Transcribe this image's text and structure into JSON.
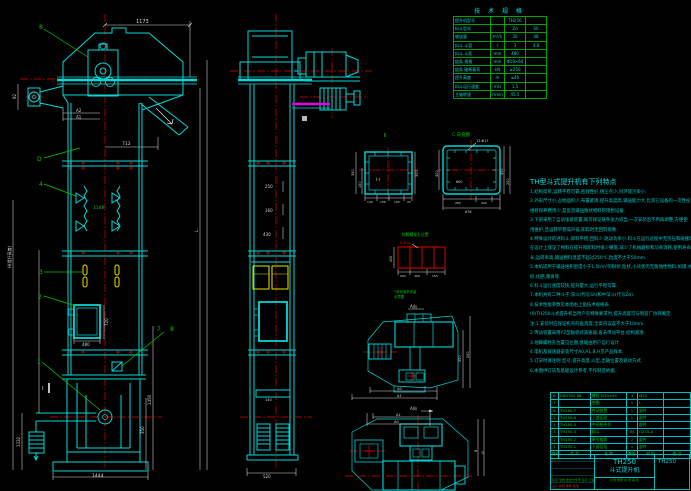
{
  "colors": {
    "cyan": "#00d9d9",
    "green": "#00cc00",
    "red": "#e60000",
    "yellow": "#e6e600",
    "magenta": "#e600e6",
    "white": "#d9d9d9",
    "bg": "#000000"
  },
  "front": {
    "balloon_8": "8",
    "balloon_d": "D",
    "balloon_4": "4",
    "balloon_3": "3",
    "balloon_2": "2",
    "balloon_1": "1",
    "balloon_7": "7",
    "balloon_8b": "8",
    "section_mark": "Ⅰ",
    "dim_top": "1173",
    "dim_head_h": "92",
    "dim_chute": "712",
    "dim_a2": "A2",
    "dim_a1": "A1",
    "dim_pitch": "1189",
    "dim_door_w": "480",
    "dim_door_h": "720",
    "dim_cw": "1332",
    "dim_boot_h": "1450",
    "dim_boot_h2": "350",
    "dim_base": "1444",
    "dim_height_label": "H(提升高度)",
    "dim_l": "L"
  },
  "side": {
    "dim_1": "250",
    "dim_2": "160",
    "dim_3": "430",
    "dim_4": "140",
    "dim_base": "520"
  },
  "section_i": {
    "label": "Ⅱ",
    "inner": "Ⅰ-Ⅰ",
    "dim_left_1": "350",
    "dim_left_2": "150",
    "dim_right": "300",
    "dims_bottom": [
      "140",
      "156",
      "195",
      "22"
    ]
  },
  "section_c": {
    "label": "C 向视图",
    "note": "12-Φ17",
    "dim_in": "600",
    "dim_b1": "260",
    "dim_b2": "200",
    "dim_total": "678",
    "dim_r1": "450",
    "dim_r2": "200",
    "dim_l": "400"
  },
  "anchor": {
    "label": "地脚螺栓孔位置",
    "note": "8-Φ18",
    "dim_left": "425",
    "dims_bottom": [
      "200",
      "300",
      "155"
    ]
  },
  "drive_side": {
    "label_1": "Y系列电机安装",
    "label_2": "示意图",
    "view_mark": "A向",
    "dim_r1": "350",
    "dim_r2": "550"
  },
  "drive_plan": {
    "view_mark": "A向",
    "dim_t1": "A0",
    "dim_t2": "A1",
    "dim_p1": "A1",
    "dim_p2": "A0",
    "dim_r1": "B",
    "dim_r2": "H"
  },
  "spec_table": {
    "title": "技 术 规 格",
    "rows": [
      {
        "label": "提升机型号",
        "unit": "",
        "v1": "TH250",
        "v2": ""
      },
      {
        "label": "料斗型式",
        "unit": "",
        "v1": "Zd",
        "v2": "Sh"
      },
      {
        "label": "输送量",
        "unit": "m³/h",
        "v1": "30",
        "v2": "48"
      },
      {
        "label": "料斗 斗容",
        "unit": "l",
        "v1": "3",
        "v2": "4.8"
      },
      {
        "label": "料斗 斗距",
        "unit": "mm",
        "v1": "480",
        "v2": ""
      },
      {
        "label": "链条 规格",
        "unit": "mm",
        "v1": "Φ18×64",
        "v2": ""
      },
      {
        "label": "链条 破断载荷",
        "unit": "kN",
        "v1": "≥250",
        "v2": ""
      },
      {
        "label": "提升高度",
        "unit": "m",
        "v1": "≤40",
        "v2": ""
      },
      {
        "label": "料斗运行速度",
        "unit": "m/s",
        "v1": "1.5",
        "v2": ""
      },
      {
        "label": "主轴转速",
        "unit": "r/min",
        "v1": "45.5",
        "v2": ""
      }
    ]
  },
  "features": {
    "heading": "TH型斗式提升机有下列特点",
    "lines": [
      "1.结构简单,运转平稳可靠,密封性好,扬尘点少,对环境污染小.",
      "2.外形尺寸小,占地面积少,布置紧凑,提升高度高,输送能力大,比其它设备的一次性投资省,",
      "  维修保养费用少,是竖直输送散状物料的理想设备.",
      "3.下部采用了自动张紧装置,既可保证链条张力适当,一次安装后不用再调整,方便使",
      "  用维护,且运转平稳噪声低,卸料时无回料现象.",
      "4.特殊设计的进料斗,卸料平稳,回料少,驱动功率小,料斗在运行过程中无挤压和碰撞现象,本机",
      "  在设计上保证了物料在提升和卸料时很少撒落,减少了机械磨损和功率消耗,使用寿命",
      "  长,运转率高,输送物料温度不超过250℃,粒度不大于50mm.",
      "5.本机适用于输送堆积密度小于1.5t/m³的粉状,粒状,小块状的无腐蚀性物料,如煤,水泥,",
      "  砂,化肥,粮食等.",
      "6.料斗运行速度较快,提升量大,运行平稳可靠.",
      "7.本机共有二种斗子:深斗(代号Sh)和中深斗(代号Zd).",
      "8.技术性能参数见本图右上角技术规格表.",
      "(9)TH250斗式提升机当用户有特殊要求时,提升高度可与制造厂协商确定.",
      "注:1.安装时应保证机壳的垂直度,全高内误差不大于10mm.",
      "   2.传动装置采用YZ型轴装式减速器,省去传动平台,结构紧凑.",
      "   3.地脚螺栓孔位置见左图,基础由用户自行设计.",
      "   4.电机及减速器安装尺寸A0,A1,B,H见产品样本.",
      "   5.订货时请注明:型号,提升高度,斗型,出轴位置及驱动方式.",
      "   6.本图供订货及基础设计参考,不作制造依据."
    ]
  },
  "bom": {
    "headers": [
      "件号",
      "代  号",
      "名  称",
      "数量",
      "材  料",
      "备 注"
    ],
    "rows": [
      [
        "8",
        "GB5782-88",
        "螺栓 M20×65",
        "4",
        "M20",
        ""
      ],
      [
        "7",
        "",
        "垫圈",
        "1",
        "L",
        ""
      ],
      [
        "6",
        "TH250.7",
        "传动装置",
        "1",
        "部件",
        ""
      ],
      [
        "5",
        "TH250.6",
        "上部区段",
        "1",
        "部件",
        ""
      ],
      [
        "4",
        "TH250.4",
        "中间机壳节",
        "",
        "部件",
        ""
      ],
      [
        "3",
        "TH250.3",
        "料斗",
        "84",
        "Q235-A",
        ""
      ],
      [
        "2",
        "TH250.2",
        "牵引链条",
        "2",
        "部件",
        ""
      ],
      [
        "1",
        "TH250.1",
        "下部区段",
        "1",
        "部件",
        ""
      ]
    ]
  },
  "title_block": {
    "model": "TH250",
    "product": "斗式提升机",
    "drawing_no": "TH250",
    "rev_row": "标记 处数 更改文件号 签字 日期",
    "sign_row": "设计  校核  审核  批准",
    "scale_row": "比例  数量  共 张  第 张"
  }
}
